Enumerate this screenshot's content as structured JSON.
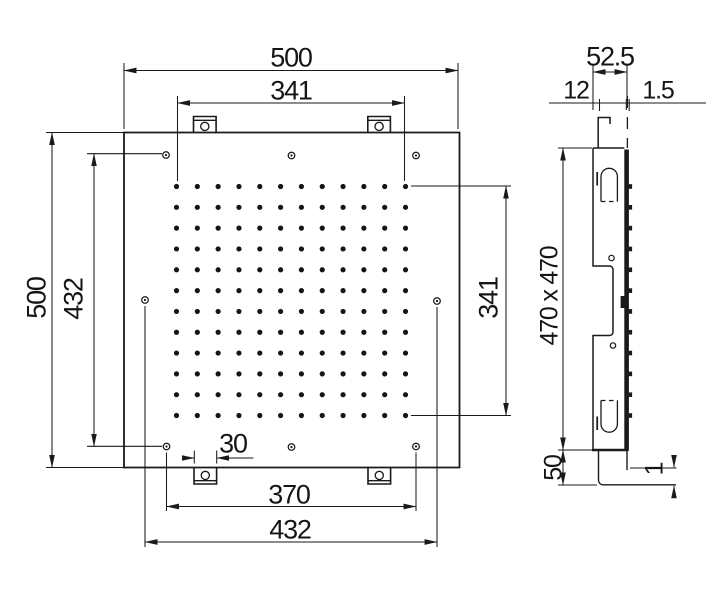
{
  "front_view": {
    "dimensions": {
      "overall_width": "500",
      "nozzle_field_width": "341",
      "overall_height": "500",
      "mount_hole_span_vertical": "432",
      "nozzle_field_height": "341",
      "tab_width": "30",
      "mount_hole_span_horizontal": "370",
      "side_hole_span": "432"
    },
    "nozzle_grid": {
      "rows": 12,
      "cols": 12
    },
    "screw_hole_count": 8,
    "mounting_tab_count": 4
  },
  "side_view": {
    "dimensions": {
      "overall_depth": "52.5",
      "hook_inset": "12",
      "panel_gap_top": "1.5",
      "housing_size": "470 x 470",
      "flange_height": "50",
      "panel_gap_bottom": "1"
    },
    "nozzle_bump_count": 12
  },
  "colors": {
    "line": "#1a1a1a",
    "background": "#ffffff"
  }
}
